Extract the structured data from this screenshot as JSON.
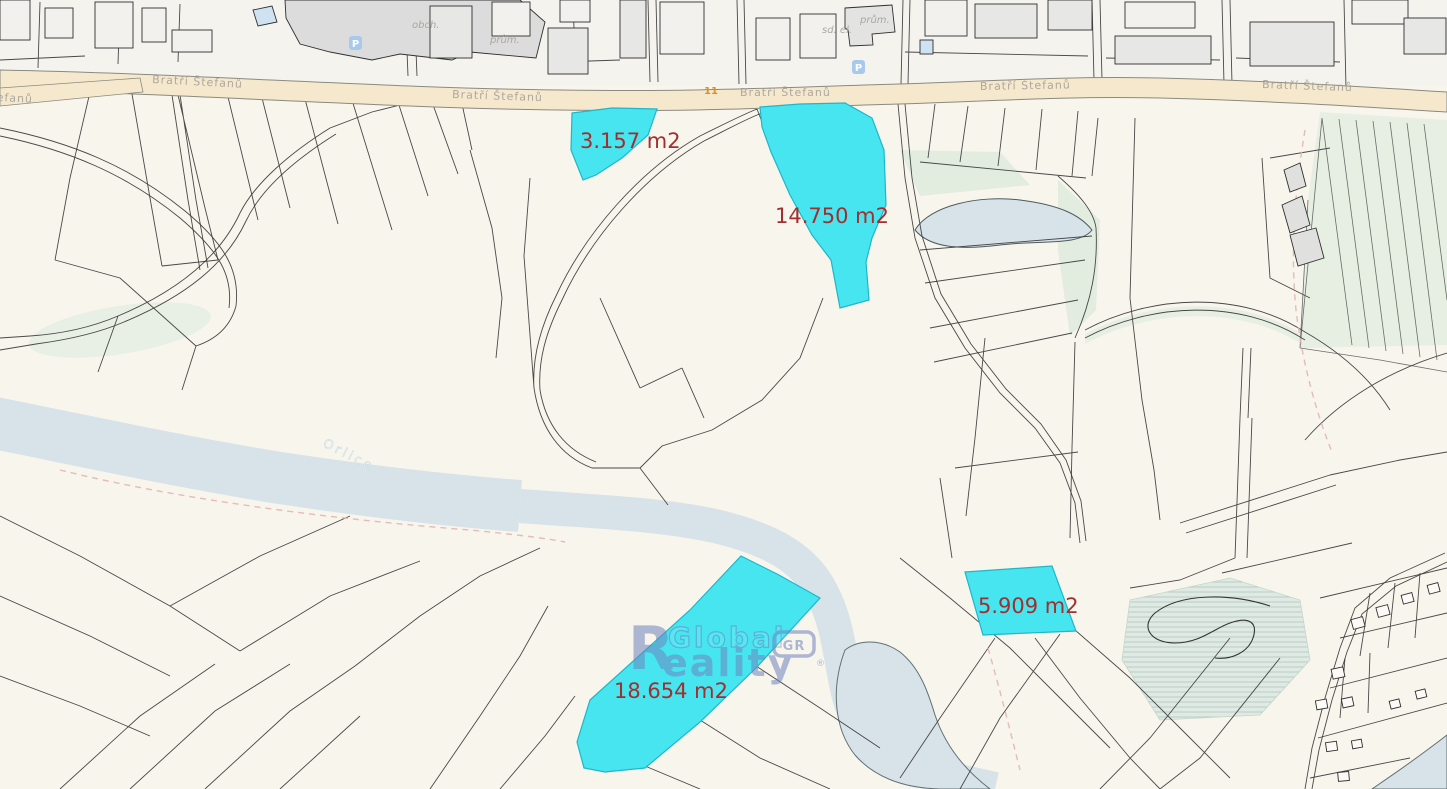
{
  "road": {
    "name": "Bratří Štefanů",
    "route_number": "11"
  },
  "river": {
    "name": "Orlice"
  },
  "highlighted_parcels": [
    {
      "area": "3.157 m2"
    },
    {
      "area": "14.750 m2"
    },
    {
      "area": "5.909 m2"
    },
    {
      "area": "18.654 m2"
    }
  ],
  "building_labels": [
    {
      "label": "obch."
    },
    {
      "label": "sd. el."
    },
    {
      "label": "prům."
    },
    {
      "label": "prům."
    }
  ],
  "icons": [
    {
      "name": "parking-icon",
      "glyph": "P"
    }
  ],
  "watermark": {
    "reality_initial": "R",
    "line1": "Global",
    "badge": "GR",
    "line2_rest": "eality",
    "registered": "®"
  },
  "colors": {
    "background": "#f8f5ec",
    "urban_background": "#f5f3ee",
    "river": "#d7e3e8",
    "road_fill": "#f6e8cd",
    "highlight": "#46e5f0",
    "highlight_border": "#1fb6c9",
    "parcel_label": "#a22f2f",
    "street_label": "#a09d95",
    "route_number": "#d98f2e",
    "boundary_line": "#3a3a3a",
    "watermark": "#6f84c0",
    "vegetation": "#e7efe2",
    "wetland": "#dfeae4",
    "building_fill": "#e7e7e5",
    "parking_icon": "#a9c9ec",
    "dashed_line": "#e2b5b5"
  }
}
